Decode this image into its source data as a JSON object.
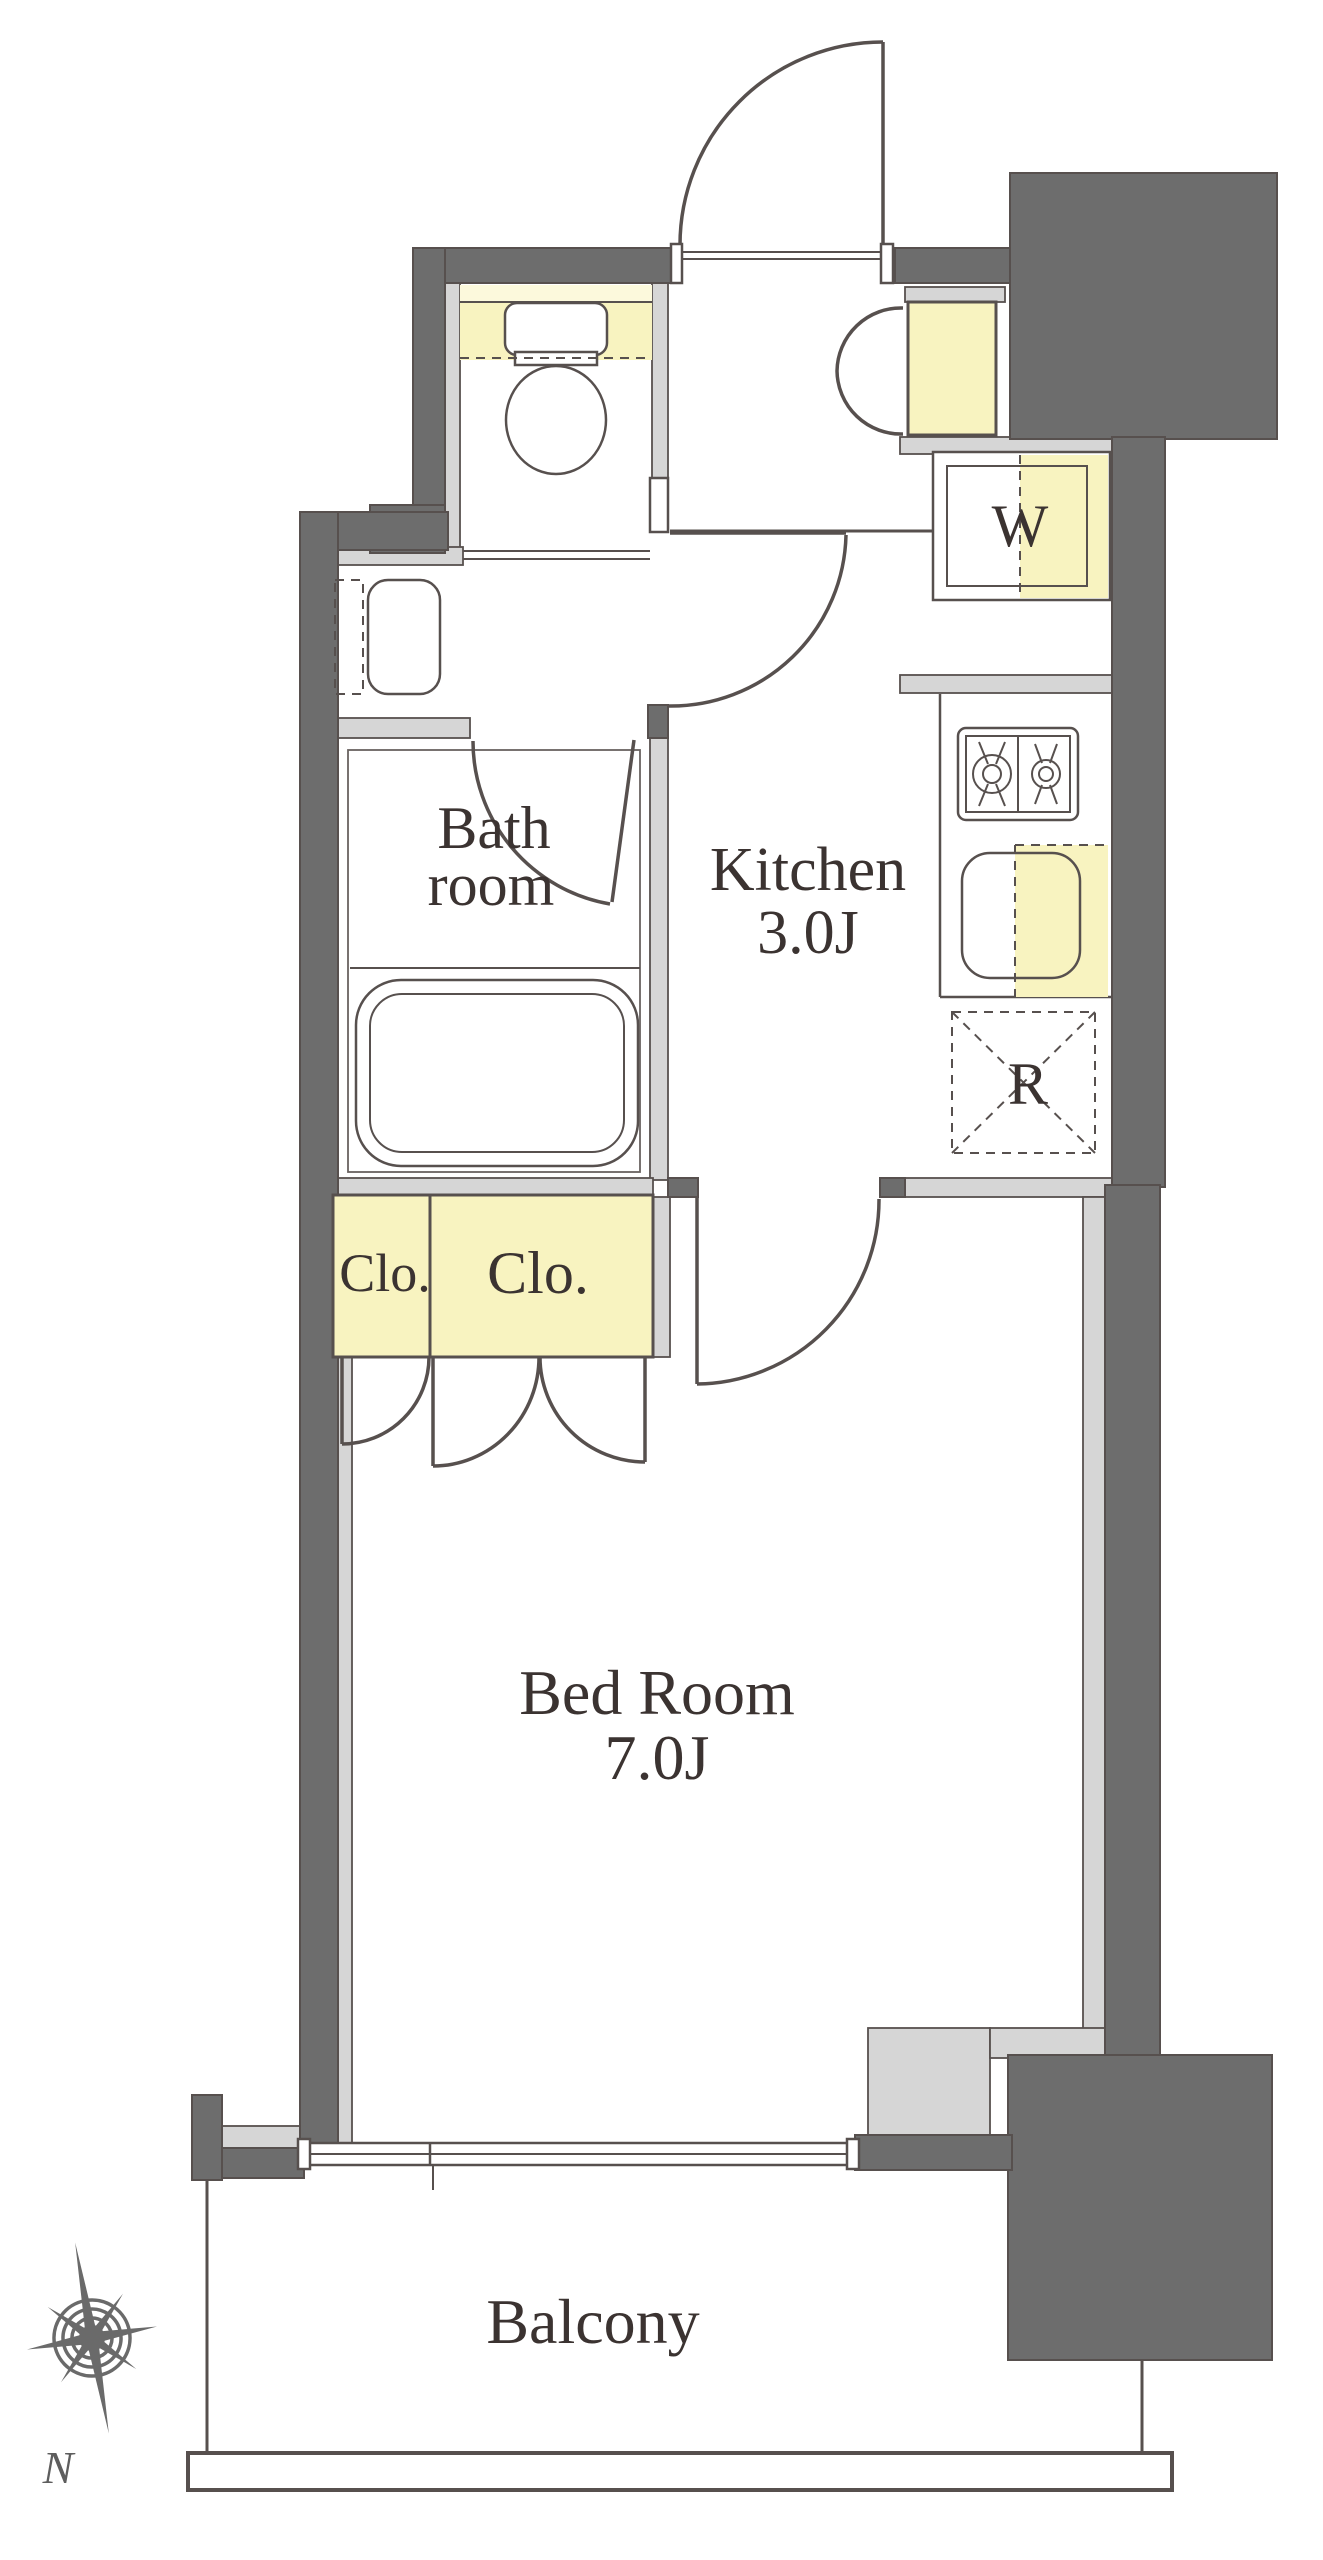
{
  "floorplan": {
    "rooms": {
      "bathroom": {
        "label_line1": "Bath",
        "label_line2": "room"
      },
      "kitchen": {
        "label": "Kitchen",
        "area": "3.0J"
      },
      "bedroom": {
        "label": "Bed Room",
        "area": "7.0J"
      },
      "balcony": {
        "label": "Balcony"
      }
    },
    "fixtures": {
      "washing_machine": "W",
      "refrigerator": "R",
      "closet_small": "Clo.",
      "closet_large": "Clo."
    },
    "compass": {
      "north_label": "N"
    },
    "colors": {
      "wall": "#6d6d6d",
      "partition": "#d6d6d6",
      "highlight": "#f8f3c0",
      "highlight_light": "#fcf9dc",
      "line": "#57504e",
      "text": "#3b3331",
      "background": "#ffffff"
    }
  }
}
